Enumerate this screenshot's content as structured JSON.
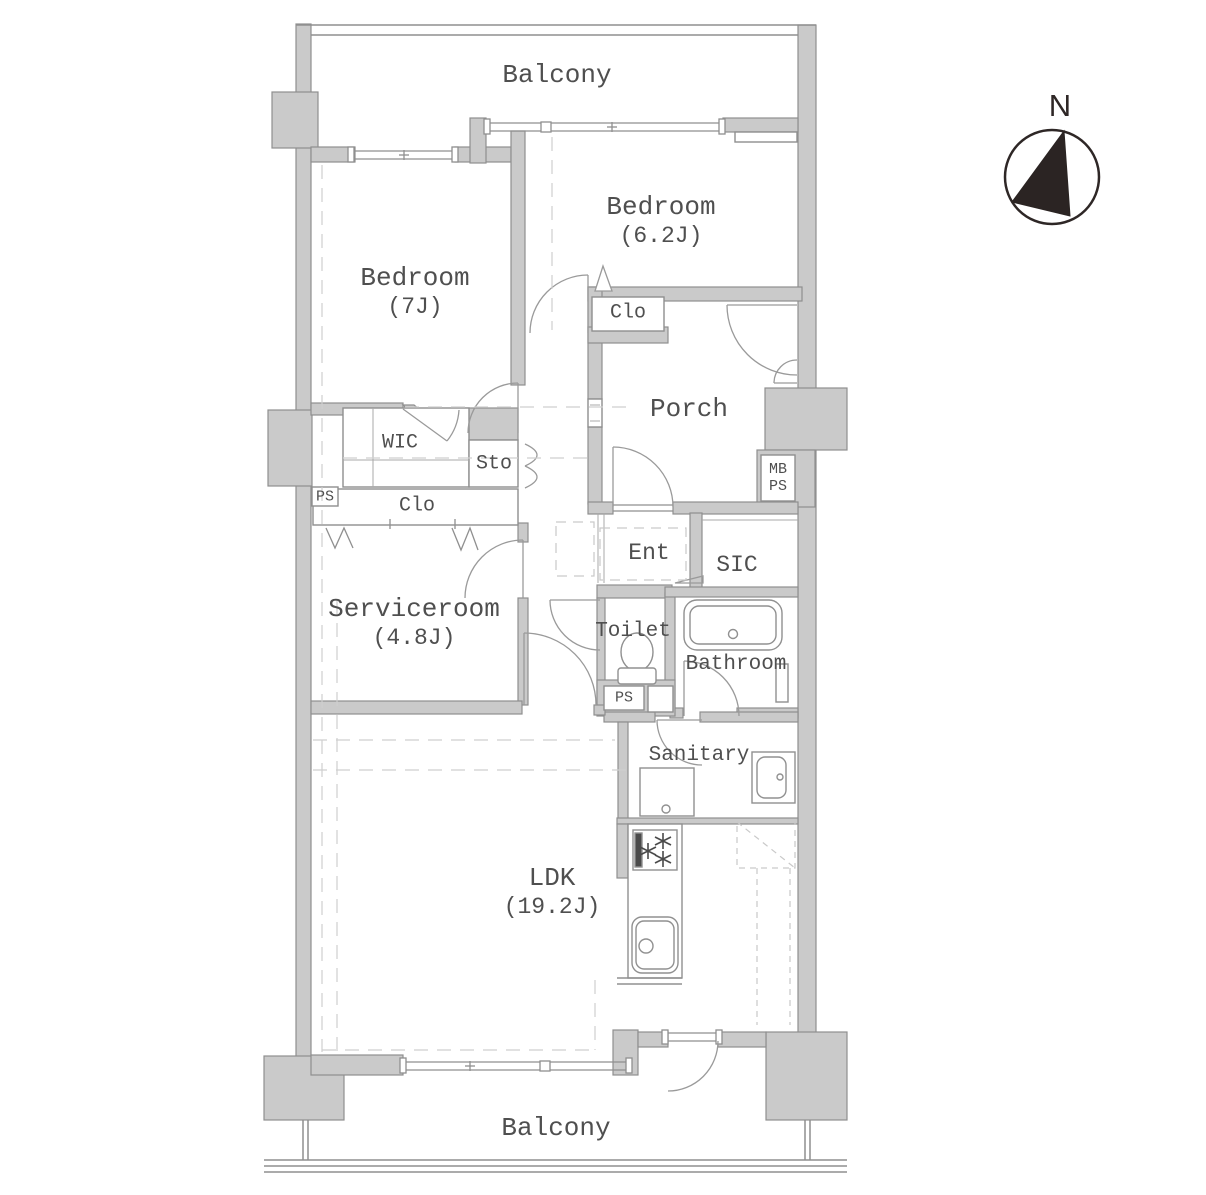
{
  "colors": {
    "wall_fill": "#cacaca",
    "wall_stroke": "#8f8f8f",
    "line": "#8f8f8f",
    "dashed_line": "#cfcfcf",
    "label_text": "#4f4f4f",
    "compass_ink": "#2e2726",
    "background": "#ffffff"
  },
  "labels": {
    "balcony_top": "Balcony",
    "bedroom1_name": "Bedroom",
    "bedroom1_size": "(7J)",
    "bedroom2_name": "Bedroom",
    "bedroom2_size": "(6.2J)",
    "clo_upper": "Clo",
    "porch": "Porch",
    "wic": "WIC",
    "sto": "Sto",
    "ps_left": "PS",
    "clo_mid": "Clo",
    "serviceroom_name": "Serviceroom",
    "serviceroom_size": "(4.8J)",
    "ent": "Ent",
    "sic": "SIC",
    "toilet": "Toilet",
    "bathroom": "Bathroom",
    "ps_small": "PS",
    "mb": "MB",
    "ps_duct": "PS",
    "sanitary": "Sanitary",
    "ldk_name": "LDK",
    "ldk_size": "(19.2J)",
    "balcony_bottom": "Balcony",
    "compass_north": "N"
  }
}
